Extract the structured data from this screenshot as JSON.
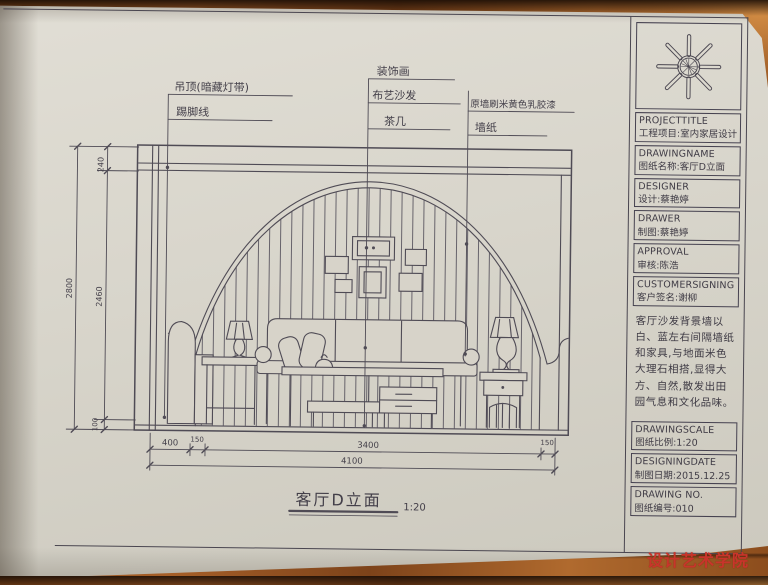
{
  "sheet": {
    "callouts": {
      "ceiling": "吊顶(暗藏灯带)",
      "skirting": "踢脚线",
      "picture": "装饰画",
      "sofa": "布艺沙发",
      "tea_table": "茶几",
      "wall_paint": "原墙刷米黄色乳胶漆",
      "wallpaper": "墙纸"
    },
    "dimensions": {
      "horizontal": {
        "segments": [
          "400",
          "150",
          "3400",
          "150"
        ],
        "total": "4100"
      },
      "vertical": {
        "segments": [
          "240",
          "2460",
          "100"
        ],
        "total": "2800"
      }
    },
    "title": {
      "name": "客厅D立面",
      "scale": "1:20"
    }
  },
  "title_block": {
    "rows": [
      {
        "en": "PROJECTTITLE",
        "zh": "工程项目:室内家居设计"
      },
      {
        "en": "DRAWINGNAME",
        "zh": "图纸名称:客厅D立面"
      },
      {
        "en": "DESIGNER",
        "zh": "设计:蔡艳婷"
      },
      {
        "en": "DRAWER",
        "zh": "制图:蔡艳婷"
      },
      {
        "en": "APPROVAL",
        "zh": "审核:陈浩"
      },
      {
        "en": "CUSTOMERSIGNING",
        "zh": "客户签名:谢柳"
      }
    ],
    "note": "客厅沙发背景墙以白、蓝左右间隔墙纸和家具,与地面米色大理石相搭,显得大方、自然,散发出田园气息和文化品味。",
    "bottom_rows": [
      {
        "en": "DRAWINGSCALE",
        "zh": "图纸比例:1:20"
      },
      {
        "en": "DESIGNINGDATE",
        "zh": "制图日期:2015.12.25"
      },
      {
        "en": "DRAWING NO.",
        "zh": "图纸编号:010"
      }
    ]
  },
  "watermark": "设计艺术学院",
  "colors": {
    "ink": "#4a4650",
    "paper": "#d7d3c9",
    "watermark_red": "#c8352b",
    "wood": "#9a5b26"
  }
}
